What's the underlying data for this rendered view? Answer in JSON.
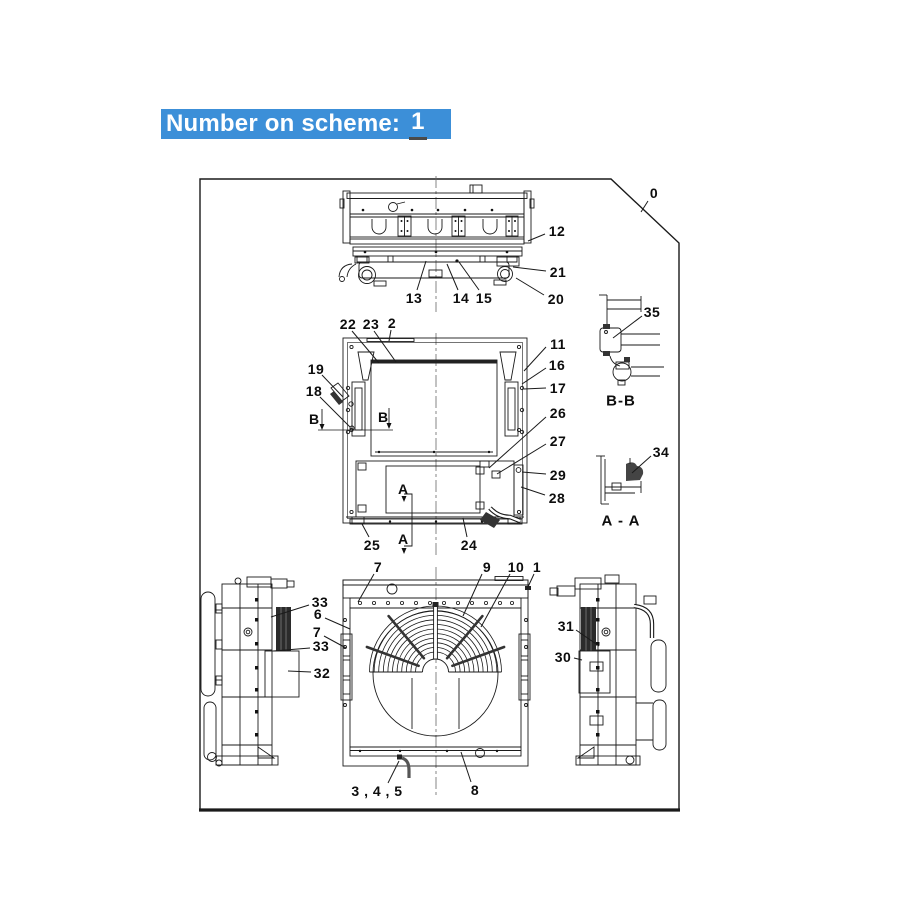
{
  "title": {
    "label": "Number on scheme:",
    "value": "1",
    "bg_color": "#3c8fd8",
    "text_color": "#ffffff"
  },
  "diagram": {
    "line_color": "#1a1a1a",
    "callouts": [
      {
        "label": "0",
        "x": 654,
        "y": 193,
        "leader": [
          648,
          201,
          641,
          212
        ]
      },
      {
        "label": "12",
        "x": 557,
        "y": 231,
        "leader": [
          545,
          234,
          528,
          241
        ]
      },
      {
        "label": "21",
        "x": 558,
        "y": 272,
        "leader": [
          546,
          271,
          513,
          267
        ]
      },
      {
        "label": "20",
        "x": 556,
        "y": 299,
        "leader": [
          544,
          295,
          516,
          278
        ]
      },
      {
        "label": "13",
        "x": 414,
        "y": 298,
        "leader": [
          417,
          290,
          426,
          261
        ]
      },
      {
        "label": "14",
        "x": 461,
        "y": 298,
        "leader": [
          458,
          290,
          447,
          264
        ]
      },
      {
        "label": "15",
        "x": 484,
        "y": 298,
        "leader": [
          479,
          290,
          459,
          262
        ]
      },
      {
        "label": "22",
        "x": 348,
        "y": 324,
        "leader": [
          352,
          331,
          379,
          363
        ]
      },
      {
        "label": "23",
        "x": 371,
        "y": 324,
        "leader": [
          374,
          331,
          396,
          362
        ]
      },
      {
        "label": "2",
        "x": 392,
        "y": 323,
        "leader": [
          391,
          330,
          389,
          341
        ]
      },
      {
        "label": "11",
        "x": 558,
        "y": 344,
        "leader": [
          546,
          347,
          524,
          371
        ]
      },
      {
        "label": "16",
        "x": 557,
        "y": 365,
        "leader": [
          546,
          368,
          522,
          384
        ]
      },
      {
        "label": "17",
        "x": 558,
        "y": 388,
        "leader": [
          546,
          388,
          524,
          389
        ]
      },
      {
        "label": "26",
        "x": 558,
        "y": 413,
        "leader": [
          546,
          417,
          489,
          468
        ]
      },
      {
        "label": "27",
        "x": 558,
        "y": 441,
        "leader": [
          546,
          444,
          497,
          474
        ]
      },
      {
        "label": "29",
        "x": 558,
        "y": 475,
        "leader": [
          546,
          474,
          522,
          472
        ]
      },
      {
        "label": "28",
        "x": 557,
        "y": 498,
        "leader": [
          545,
          495,
          521,
          487
        ]
      },
      {
        "label": "19",
        "x": 316,
        "y": 369,
        "leader": [
          322,
          375,
          343,
          397
        ]
      },
      {
        "label": "18",
        "x": 314,
        "y": 391,
        "leader": [
          320,
          397,
          350,
          427
        ]
      },
      {
        "label": "25",
        "x": 372,
        "y": 545,
        "leader": [
          369,
          537,
          362,
          524
        ]
      },
      {
        "label": "24",
        "x": 469,
        "y": 545,
        "leader": [
          467,
          537,
          463,
          518
        ]
      },
      {
        "label": "35",
        "x": 652,
        "y": 312,
        "leader": [
          642,
          316,
          613,
          338
        ]
      },
      {
        "label": "34",
        "x": 661,
        "y": 452,
        "leader": [
          651,
          456,
          632,
          473
        ]
      },
      {
        "label": "33",
        "x": 320,
        "y": 602,
        "leader": [
          309,
          605,
          271,
          617
        ]
      },
      {
        "label": "6",
        "x": 318,
        "y": 614,
        "leader": [
          325,
          618,
          350,
          629
        ]
      },
      {
        "label": "7",
        "x": 317,
        "y": 632,
        "leader": [
          324,
          636,
          346,
          648
        ]
      },
      {
        "label": "33",
        "x": 321,
        "y": 646,
        "leader": [
          310,
          648,
          273,
          651
        ]
      },
      {
        "label": "32",
        "x": 322,
        "y": 673,
        "leader": [
          311,
          672,
          288,
          671
        ]
      },
      {
        "label": "7",
        "x": 378,
        "y": 567,
        "leader": [
          374,
          574,
          358,
          602
        ]
      },
      {
        "label": "9",
        "x": 487,
        "y": 567,
        "leader": [
          482,
          574,
          463,
          616
        ]
      },
      {
        "label": "10",
        "x": 516,
        "y": 567,
        "leader": [
          510,
          574,
          481,
          627
        ]
      },
      {
        "label": "1",
        "x": 537,
        "y": 567,
        "leader": [
          534,
          574,
          527,
          589
        ]
      },
      {
        "label": "3 , 4 , 5",
        "x": 377,
        "y": 791,
        "leader": [
          388,
          783,
          399,
          761
        ]
      },
      {
        "label": "8",
        "x": 475,
        "y": 790,
        "leader": [
          471,
          782,
          461,
          752
        ]
      },
      {
        "label": "31",
        "x": 566,
        "y": 626,
        "leader": [
          576,
          630,
          599,
          646
        ]
      },
      {
        "label": "30",
        "x": 563,
        "y": 657,
        "leader": [
          574,
          658,
          582,
          660
        ]
      }
    ],
    "section_letters": [
      {
        "label": "B",
        "x": 314,
        "y": 419
      },
      {
        "label": "B",
        "x": 383,
        "y": 417
      },
      {
        "label": "A",
        "x": 403,
        "y": 489
      },
      {
        "label": "A",
        "x": 403,
        "y": 539
      }
    ],
    "view_labels": [
      {
        "label": "B-B",
        "x": 621,
        "y": 401
      },
      {
        "label": "A - A",
        "x": 621,
        "y": 521
      }
    ]
  }
}
